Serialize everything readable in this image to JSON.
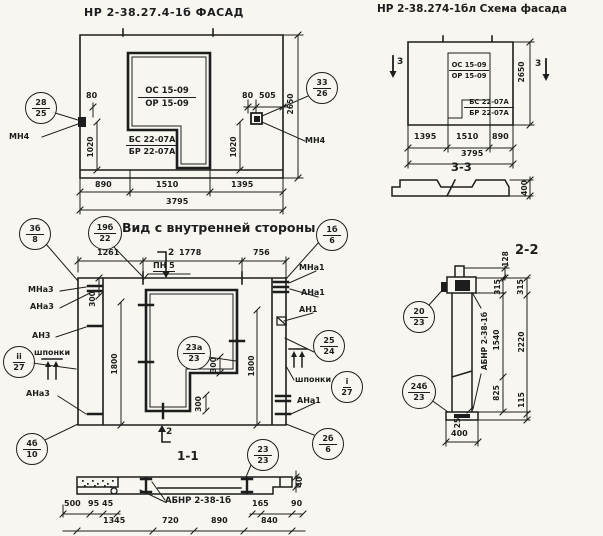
{
  "palette": {
    "paper": "#f7f6f0",
    "ink": "#1d1d1d"
  },
  "facade": {
    "title": "НР 2-38.27.4-1б  ФАСАД",
    "window_mark_top": "ОС 15-09",
    "window_mark_bottom": "ОР 15-09",
    "panel_mark_top": "БС 22-07А",
    "panel_mark_bottom": "БР 22-07А",
    "anchor_left": "МН4",
    "anchor_right": "МН4",
    "callout_left": {
      "t": "28",
      "b": "25"
    },
    "callout_right": {
      "t": "33",
      "b": "26"
    },
    "dims": {
      "d80l": "80",
      "d1020l": "1020",
      "d80r": "80",
      "d505": "505",
      "d1020r": "1020",
      "d2650": "2650",
      "d890": "890",
      "d1510": "1510",
      "d1395": "1395",
      "d3795": "3795"
    }
  },
  "schema": {
    "title": "НР 2-38.274-1бл  Схема фасада",
    "window_mark_top": "ОС 15-09",
    "window_mark_bottom": "ОР 15-09",
    "panel_mark_top": "БС 22-07А",
    "panel_mark_bottom": "БР 22-07А",
    "mark3_left": "3",
    "mark3_right": "3",
    "dims": {
      "d2650": "2650",
      "d1395": "1395",
      "d1510": "1510",
      "d890": "890",
      "d3795": "3795"
    }
  },
  "section33": {
    "title": "3-3",
    "d400": "400"
  },
  "inner": {
    "title": "Вид с внутренней стороны",
    "pn5": "ПН 5",
    "mark2_top": "2",
    "mark2_bottom": "2",
    "labels": {
      "mna3": "МНа3",
      "ana3": "АНа3",
      "an3": "АН3",
      "shponki_left": "шпонки",
      "ana3_bottom": "АНа3",
      "mna1": "МНа1",
      "ana1": "АНа1",
      "an1": "АН1",
      "shponki_right": "шпонки",
      "ana1_bottom": "АНа1"
    },
    "callouts": {
      "c3b8": {
        "t": "3б",
        "b": "8"
      },
      "c19b22": {
        "t": "19б",
        "b": "22"
      },
      "c1b6": {
        "t": "1б",
        "b": "6"
      },
      "c23a23": {
        "t": "23а",
        "b": "23"
      },
      "cii27": {
        "t": "ii",
        "b": "27"
      },
      "ci27": {
        "t": "i",
        "b": "27"
      },
      "c2524": {
        "t": "25",
        "b": "24"
      },
      "c2b6": {
        "t": "2б",
        "b": "6"
      },
      "c4b10": {
        "t": "4б",
        "b": "10"
      }
    },
    "dims": {
      "d1261": "1261",
      "d1778": "1778",
      "d756": "756",
      "d300_top": "300",
      "d300_mid": "300",
      "d300_bottom": "300",
      "d1800_left": "1800",
      "d1800_right": "1800"
    }
  },
  "section11": {
    "title": "1-1",
    "label": "АБНР 2-38-1б",
    "callout": {
      "t": "23",
      "b": "23"
    },
    "dims": {
      "d500": "500",
      "d95": "95",
      "d45": "45",
      "d1345": "1345",
      "d720": "720",
      "d890": "890",
      "d165": "165",
      "d90": "90",
      "d840": "840",
      "d40": "40"
    }
  },
  "section22": {
    "title": "2-2",
    "label": "АБНР 2-38-1б",
    "callout_top": {
      "t": "20",
      "b": "23"
    },
    "callout_bottom": {
      "t": "24б",
      "b": "23"
    },
    "dims": {
      "d128": "128",
      "d315i": "315",
      "d1540": "1540",
      "d825": "825",
      "d315o": "315",
      "d2220": "2220",
      "d115": "115",
      "d25": "25",
      "d400": "400"
    }
  }
}
